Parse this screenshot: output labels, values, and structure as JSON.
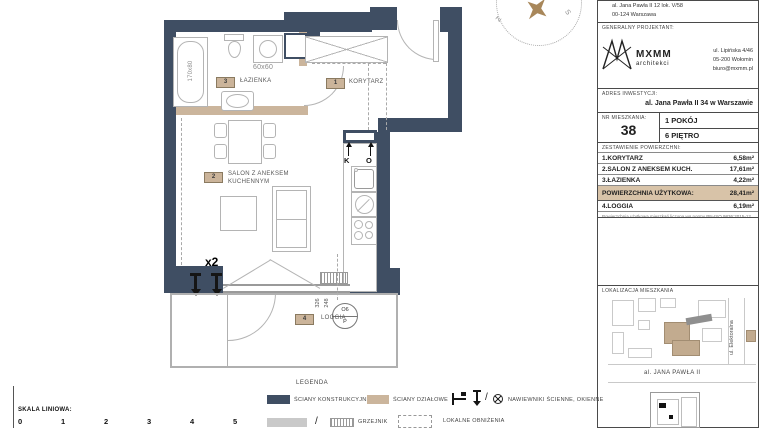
{
  "plan": {
    "compass": {
      "letter_left": "Z",
      "letter_right": "S"
    },
    "rooms": {
      "korytarz": {
        "no": "1",
        "label": "KORYTARZ"
      },
      "salon": {
        "no": "2",
        "label": "SALON Z ANEKSEM KUCHENNYM"
      },
      "lazienka": {
        "no": "3",
        "label": "ŁAZIENKA"
      },
      "loggia": {
        "no": "4",
        "label": "LOGGIA"
      }
    },
    "annotations": {
      "bathtub_dim": "170x80",
      "washer_dim": "60x60",
      "vents_count": "x2",
      "riser_k": "K",
      "riser_o": "O",
      "dim_a": "326",
      "dim_b": "248",
      "window_mark_top": "O6",
      "window_mark_bottom": "P"
    }
  },
  "title_block": {
    "investor_address": {
      "line1": "al. Jana Pawła II 12 lok. V/58",
      "line2": "00-124 Warszawa"
    },
    "designer": {
      "label": "GENERALNY PROJEKTANT:",
      "brand": "MXMM",
      "brand_sub": "architekci",
      "address_line1": "ul. Lipińska 4/46",
      "address_line2": "05-200 Wołomin",
      "address_line3": "biuro@mxmm.pl"
    },
    "investment": {
      "label": "ADRES INWESTYCJI:",
      "value": "al. Jana Pawła II 34 w Warszawie"
    },
    "apartment": {
      "label": "NR MIESZKANIA:",
      "number": "38",
      "rooms": "1 POKÓJ",
      "floor": "6 PIĘTRO"
    },
    "areas": {
      "label": "ZESTAWIENIE POWIERZCHNI:",
      "rows": [
        {
          "name": "1.KORYTARZ",
          "value": "6,58m²"
        },
        {
          "name": "2.SALON Z ANEKSEM KUCH.",
          "value": "17,61m²"
        },
        {
          "name": "3.ŁAZIENKA",
          "value": "4,22m²"
        }
      ],
      "total_name": "POWIERZCHNIA UŻYTKOWA:",
      "total_value": "28,41m²",
      "loggia_name": "4.LOGGIA",
      "loggia_value": "6,19m²",
      "note": "Powierzchnia użytkowa mieszkań liczona wg normy PN-ISO 9836:2015-12"
    },
    "location": {
      "label": "LOKALIZACJA MIESZKANIA",
      "street_v": "ul. Elektoralna",
      "street_h": "al. JANA PAWŁA II"
    }
  },
  "legend": {
    "title": "LEGENDA",
    "walls_structural": "ŚCIANY KONSTRUKCYJNE",
    "walls_partition": "ŚCIANY DZIAŁOWE",
    "vents": "NAWIEWNIKI ŚCIENNE, OKIENNE",
    "radiator": "GRZEJNIK",
    "ceiling": "LOKALNE OBNIŻENIA",
    "slash": "/"
  },
  "scale_bar": {
    "label": "SKALA LINIOWA:",
    "ticks": [
      "0",
      "1",
      "2",
      "3",
      "4",
      "5"
    ]
  }
}
